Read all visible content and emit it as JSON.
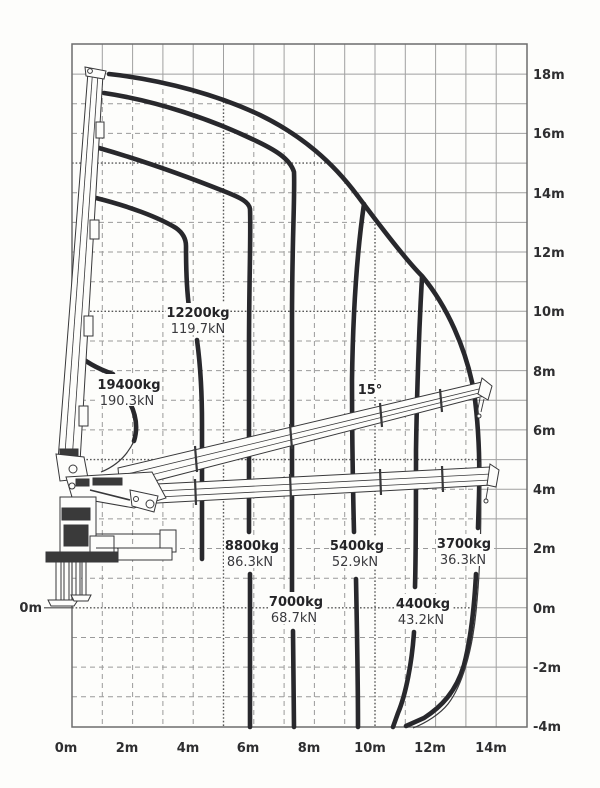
{
  "colors": {
    "background": "#fdfdfb",
    "grid_solid": "#9e9e9e",
    "grid_dashed": "#9a9a9a",
    "grid_dotted_major": "#555555",
    "curve": "#28282c",
    "crane_line": "#38383a",
    "text": "#2e2e30"
  },
  "ground_label": "0m",
  "angle_label": "15°",
  "curve_labels": [
    {
      "kg": "19400kg",
      "kn": "190.3kN"
    },
    {
      "kg": "12200kg",
      "kn": "119.7kN"
    },
    {
      "kg": "8800kg",
      "kn": "86.3kN"
    },
    {
      "kg": "7000kg",
      "kn": "68.7kN"
    },
    {
      "kg": "5400kg",
      "kn": "52.9kN"
    },
    {
      "kg": "4400kg",
      "kn": "43.2kN"
    },
    {
      "kg": "3700kg",
      "kn": "36.3kN"
    }
  ],
  "x_ticks": [
    "0m",
    "2m",
    "4m",
    "6m",
    "8m",
    "10m",
    "12m",
    "14m"
  ],
  "y_ticks": [
    "18m",
    "16m",
    "14m",
    "12m",
    "10m",
    "8m",
    "6m",
    "4m",
    "2m",
    "0m",
    "-2m",
    "-4m"
  ],
  "chart_data": {
    "type": "line",
    "title": "Loader crane lifting capacity diagram (load chart with crane silhouette)",
    "xlabel": "outreach (m)",
    "ylabel": "height (m)",
    "x_range_m": [
      0,
      15
    ],
    "y_range_m": [
      -4,
      19
    ],
    "x_tick_labels": [
      "0m",
      "2m",
      "4m",
      "6m",
      "8m",
      "10m",
      "12m",
      "14m"
    ],
    "y_tick_labels": [
      "18m",
      "16m",
      "14m",
      "12m",
      "10m",
      "8m",
      "6m",
      "4m",
      "2m",
      "0m",
      "-2m",
      "-4m"
    ],
    "grid": "1 m grid; dashed inside working envelope, solid outside; dotted emphasis every 5 m and at 0 m ground line",
    "boom_angle_annotation": "15°",
    "capacity_curves": [
      {
        "load": "19400kg",
        "force": "190.3kN",
        "approx_max_outreach_m": 2.1
      },
      {
        "load": "12200kg",
        "force": "119.7kN",
        "approx_max_outreach_m": 4.3
      },
      {
        "load": "8800kg",
        "force": "86.3kN",
        "approx_max_outreach_m": 5.9
      },
      {
        "load": "7000kg",
        "force": "68.7kN",
        "approx_max_outreach_m": 7.3
      },
      {
        "load": "5400kg",
        "force": "52.9kN",
        "approx_max_outreach_m": 9.4
      },
      {
        "load": "4400kg",
        "force": "43.2kN",
        "approx_max_outreach_m": 11.4
      },
      {
        "load": "3700kg",
        "force": "36.3kN",
        "approx_max_outreach_m": 13.2
      }
    ],
    "working_envelope": {
      "max_outreach_m": 13.5,
      "max_height_m": 18,
      "min_height_m": -4
    }
  }
}
